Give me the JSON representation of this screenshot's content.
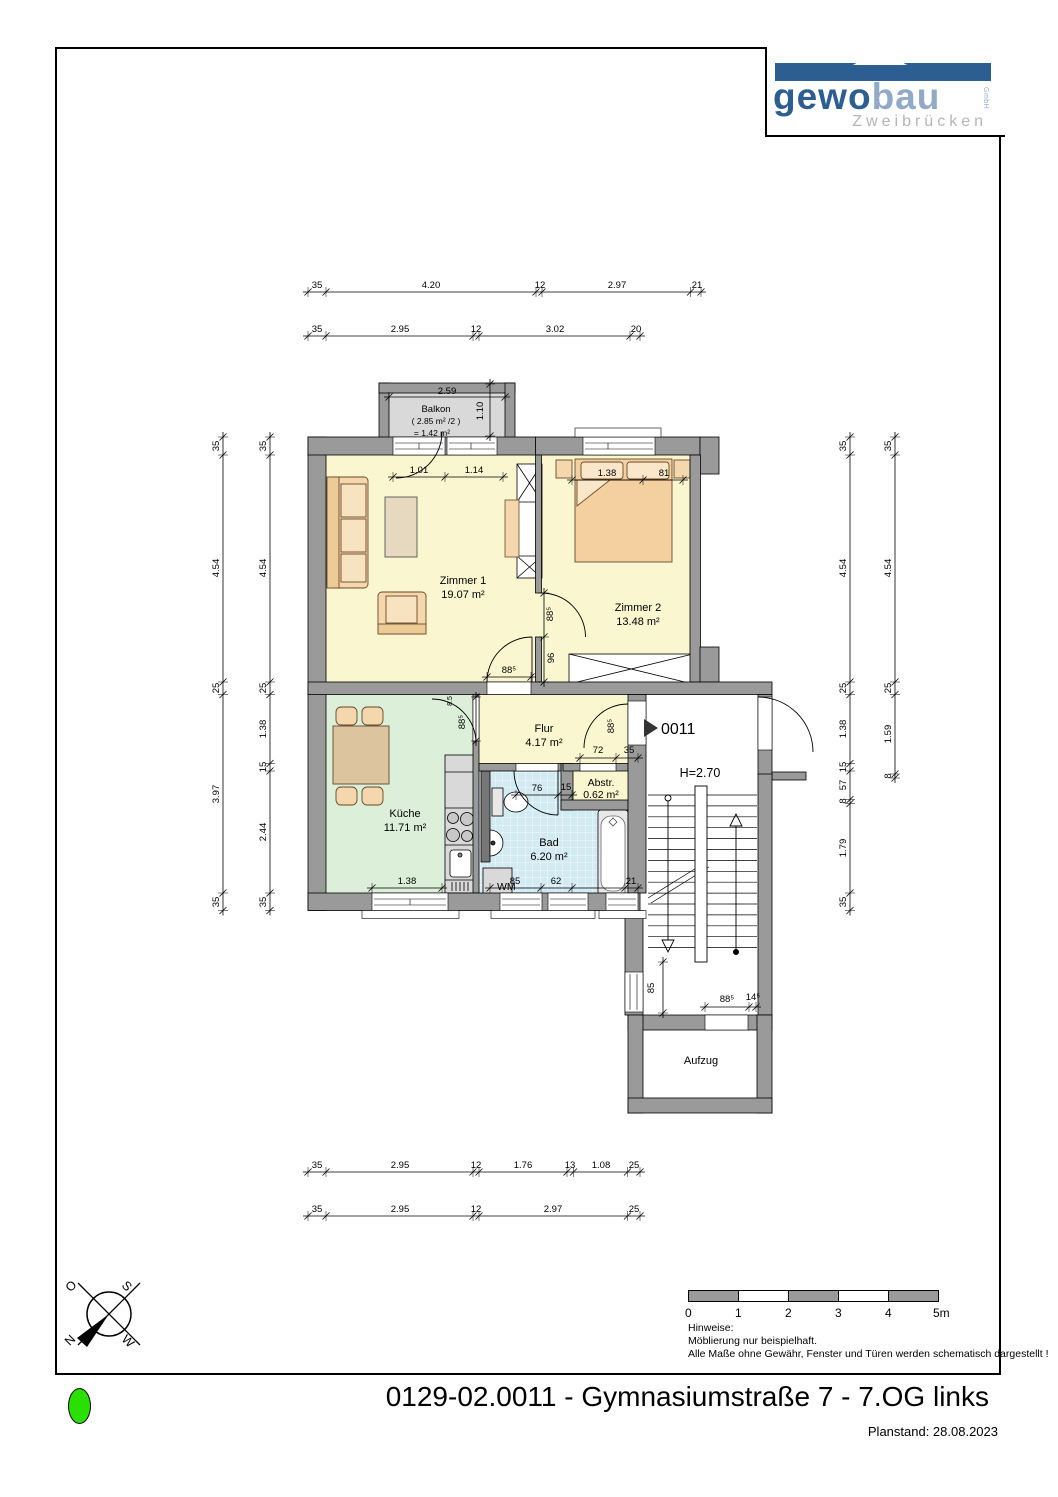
{
  "logo": {
    "brand_bold": "gewo",
    "brand_light": "bau",
    "brand_suffix": "GmbH",
    "city": "Zweibrücken"
  },
  "footer": {
    "title": "0129-02.0011 - Gymnasiumstraße 7 - 7.OG links",
    "planstand": "Planstand: 28.08.2023"
  },
  "legend": {
    "scale_ticks": [
      "0",
      "1",
      "2",
      "3",
      "4",
      "5m"
    ],
    "notes": [
      "Hinweise:",
      "Möblierung nur beispielhaft.",
      "Alle Maße ohne Gewähr, Fenster und Türen werden schematisch dargestellt !"
    ]
  },
  "compass": {
    "top_left": "O",
    "top_right": "S",
    "bottom_left": "N",
    "bottom_right": "W"
  },
  "rooms": {
    "zimmer1": {
      "name": "Zimmer 1",
      "area": "19.07 m²"
    },
    "zimmer2": {
      "name": "Zimmer 2",
      "area": "13.48 m²"
    },
    "flur": {
      "name": "Flur",
      "area": "4.17 m²"
    },
    "kueche": {
      "name": "Küche",
      "area": "11.71 m²"
    },
    "bad": {
      "name": "Bad",
      "area": "6.20 m²"
    },
    "abstr": {
      "name": "Abstr.",
      "area": "0.62 m²"
    },
    "balkon": {
      "name": "Balkon",
      "area_calc": "( 2.85 m² /2 )",
      "area": "= 1.42 m²"
    },
    "aufzug": {
      "name": "Aufzug"
    },
    "wm": "WM",
    "entry_label": "0011",
    "ceiling_height": "H=2.70"
  },
  "dims": {
    "top1": [
      "35",
      "4.20",
      "12",
      "2.97",
      "21"
    ],
    "top2": [
      "35",
      "2.95",
      "12",
      "3.02",
      "20"
    ],
    "bottom1": [
      "35",
      "2.95",
      "12",
      "1.76",
      "13",
      "1.08",
      "25"
    ],
    "bottom2": [
      "35",
      "2.95",
      "12",
      "2.97",
      "25"
    ],
    "left_outer": [
      "35",
      "4.54",
      "25",
      "3.97",
      "35"
    ],
    "left_inner": [
      "35",
      "4.54",
      "25",
      "1.38",
      "15",
      "2.44",
      "35"
    ],
    "right_inner": [
      "35",
      "4.54",
      "25",
      "1.38",
      "15",
      "57",
      "8",
      "1.79",
      "35"
    ],
    "right_outer": [
      "35",
      "4.54",
      "25",
      "1.59",
      "8"
    ],
    "balkon_w": "2.59",
    "balkon_d": "1.10",
    "zimmer1_win": [
      "1.01",
      "1.14"
    ],
    "zimmer2_win": [
      "1.38",
      "81"
    ],
    "door_z1": "88⁵",
    "door_z2": "88⁵",
    "z2_stub": "96",
    "door_kueche": "88⁵",
    "kueche_off": "8.5",
    "door_entry": "88⁵",
    "flur_dims": [
      "72",
      "35"
    ],
    "bad_door": [
      "76",
      "15"
    ],
    "bad_bottom": [
      "85",
      "62",
      "21"
    ],
    "kueche_bottom": "1.38",
    "stair_win": "85",
    "aufzug_door": [
      "88⁵",
      "14⁵"
    ]
  }
}
